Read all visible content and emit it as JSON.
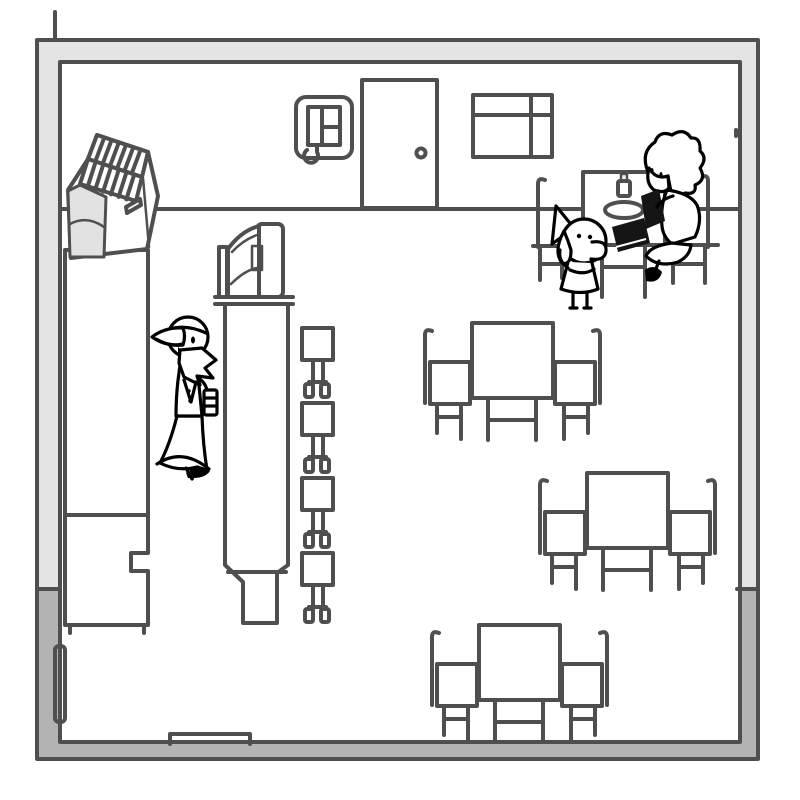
{
  "palette": {
    "background": "#ffffff",
    "ink_furniture": "#4f4f4f",
    "ink_character": "#000000",
    "wall_light": "#e4e4e4",
    "wall_dark": "#b3b3b3",
    "dark_fill": "#151515",
    "register_side": "#e2e2e2"
  },
  "scene": {
    "setting_label": "Hand-drawn sketch of a small cafe interior",
    "objects": [
      {
        "name": "cash-register",
        "location": "on left counter, top-left"
      },
      {
        "name": "service-counter",
        "location": "along left wall"
      },
      {
        "name": "center-counter",
        "location": "middle-left of room"
      },
      {
        "name": "menu-display-stand",
        "location": "on top of center counter"
      },
      {
        "name": "wall-phone",
        "location": "back wall, left of door"
      },
      {
        "name": "door",
        "location": "back wall, center, with round knob"
      },
      {
        "name": "menu-board",
        "location": "back wall, right of door"
      },
      {
        "name": "doormat",
        "location": "bottom wall, left of center"
      },
      {
        "name": "wall-panel",
        "location": "inside lower-left wall"
      }
    ],
    "furniture_counts": {
      "tables": 4,
      "chairs": 8,
      "stools": 4
    },
    "characters": [
      {
        "name": "bird-waiter",
        "pose": "standing between counters holding a striped cup"
      },
      {
        "name": "dog-customer",
        "pose": "seated at upper-right table, paw raised"
      },
      {
        "name": "shaggy-hair-customer",
        "pose": "seated cross-legged at upper-right table reading a dark menu"
      }
    ],
    "table_items": [
      "bottle",
      "plate",
      "black book"
    ]
  }
}
